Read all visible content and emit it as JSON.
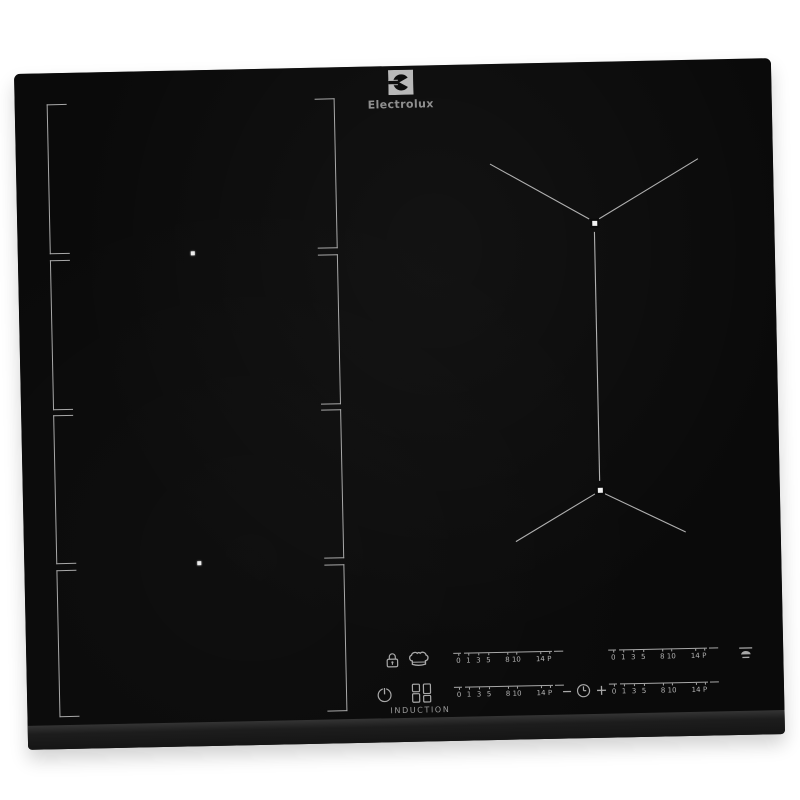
{
  "brand": {
    "logo_text": "Electrolux"
  },
  "colors": {
    "bg": "#ffffff",
    "glass": "#0a0a0a",
    "bevel": "#151515",
    "mark": "#a8a8a8",
    "logo_square": "#b8b8b8"
  },
  "zones": {
    "left_flex_segment_count": "4",
    "left_zone_center_dots": "2",
    "right_zone_marker_count": "2"
  },
  "controls": {
    "induction_label": "INDUCTION",
    "power_scale": {
      "labels": [
        "0",
        "1",
        "3",
        "5",
        "8",
        "10",
        "14",
        "P"
      ]
    },
    "timer": {
      "minus_label": "−",
      "plus_label": "+"
    },
    "icons": {
      "lock": "lock-icon",
      "chef_hat": "chef-hat-icon",
      "power": "power-icon",
      "flex_zones": "flex-zones-icon",
      "timer_clock": "timer-clock-icon",
      "hob2hood": "hob2hood-icon"
    }
  }
}
